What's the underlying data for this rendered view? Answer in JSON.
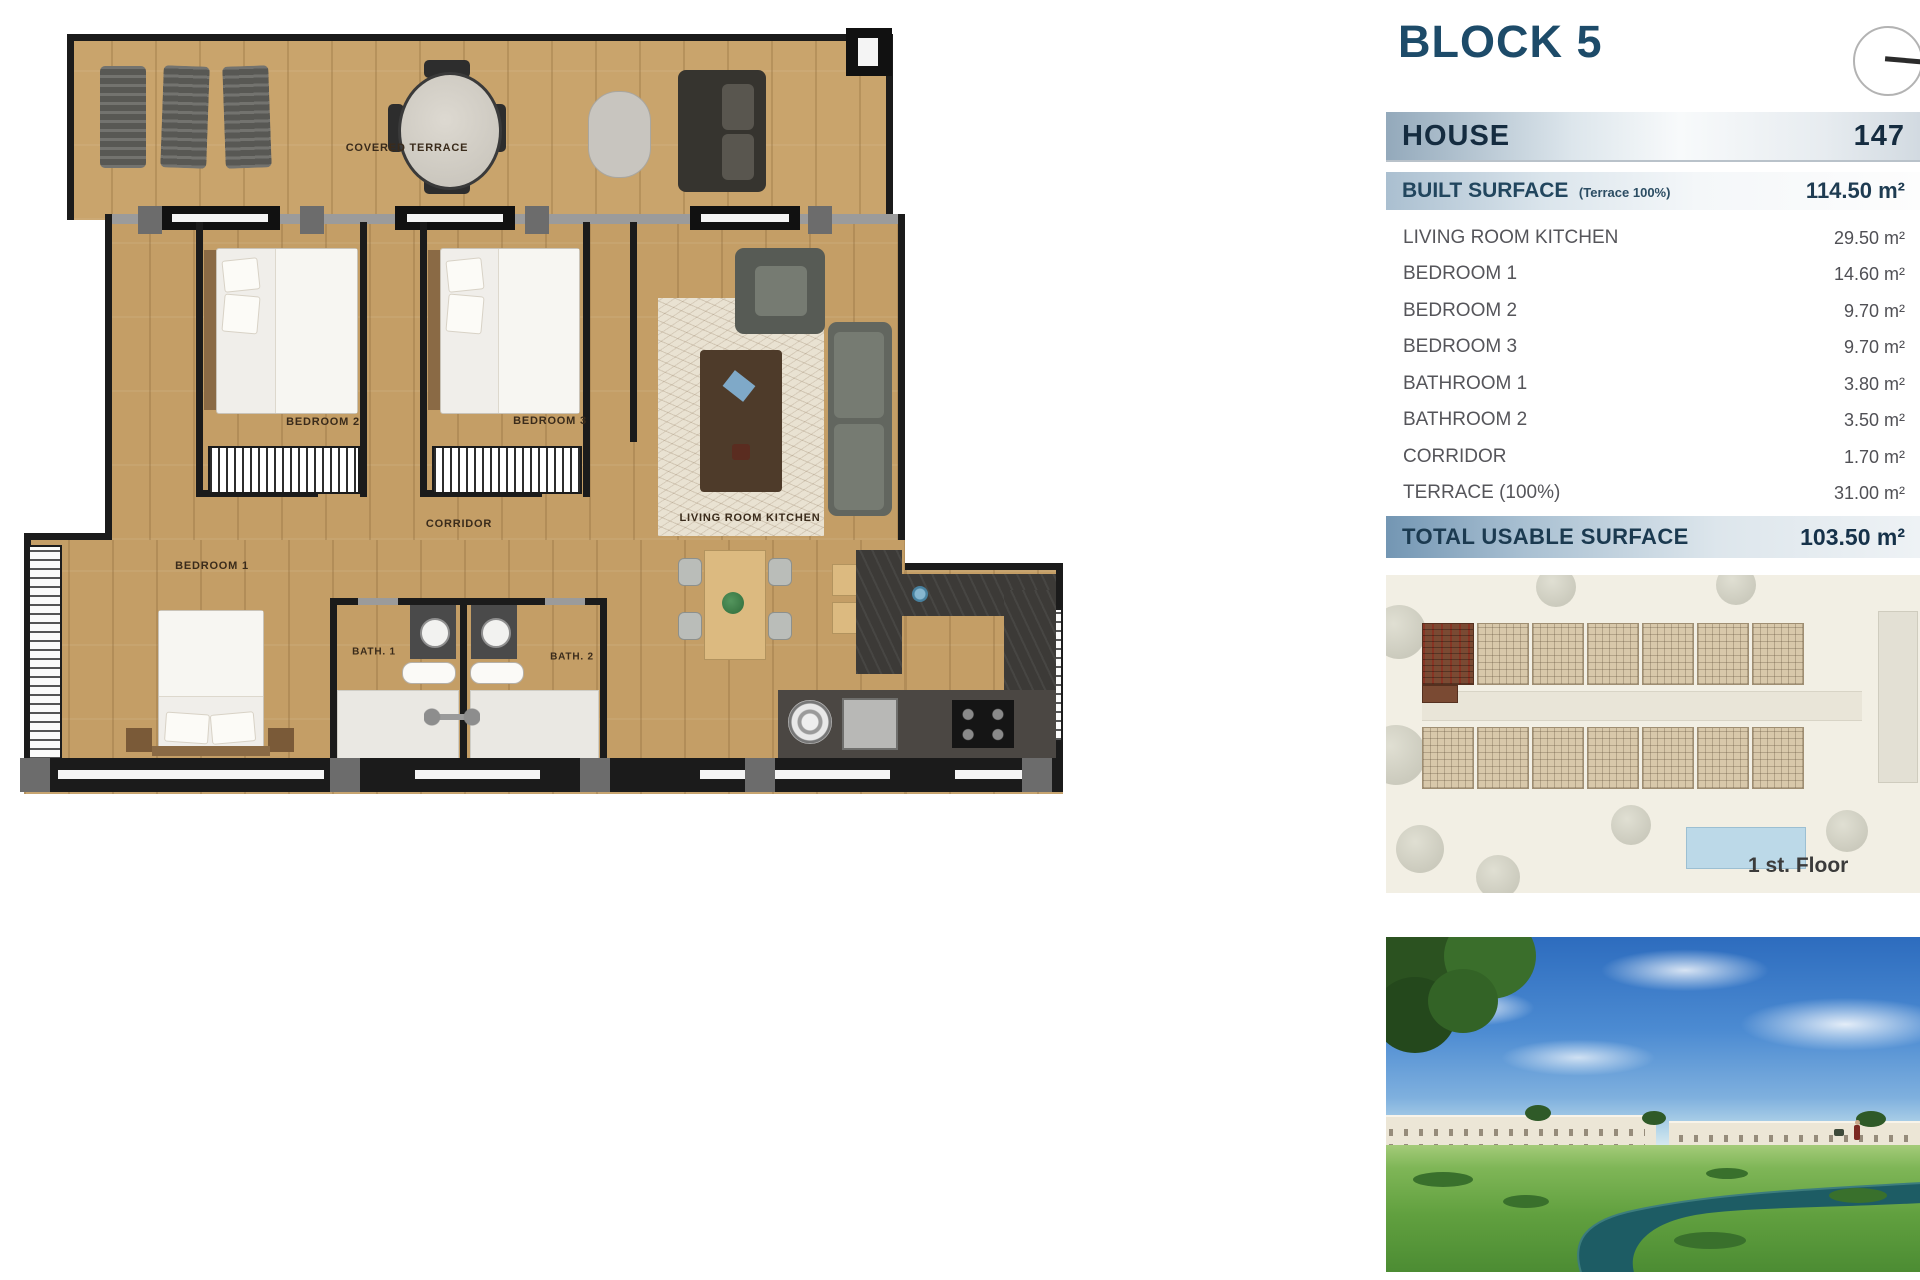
{
  "panel": {
    "title": "BLOCK 5",
    "house_label": "HOUSE",
    "house_value": "147",
    "built_label": "BUILT SURFACE",
    "built_note": "(Terrace 100%)",
    "built_value": "114.50 m²",
    "rooms": [
      {
        "label": "LIVING ROOM KITCHEN",
        "value": "29.50 m²"
      },
      {
        "label": "BEDROOM 1",
        "value": "14.60 m²"
      },
      {
        "label": "BEDROOM 2",
        "value": "9.70 m²"
      },
      {
        "label": "BEDROOM 3",
        "value": "9.70 m²"
      },
      {
        "label": "BATHROOM 1",
        "value": "3.80 m²"
      },
      {
        "label": "BATHROOM 2",
        "value": "3.50 m²"
      },
      {
        "label": "CORRIDOR",
        "value": "1.70 m²"
      },
      {
        "label": "TERRACE (100%)",
        "value": "31.00 m²"
      }
    ],
    "total_label": "TOTAL USABLE SURFACE",
    "total_value": "103.50 m²",
    "floor_caption": "1 st. Floor"
  },
  "plan": {
    "covered_terrace": "COVERED TERRACE",
    "bedroom2": "BEDROOM 2",
    "bedroom3": "BEDROOM 3",
    "corridor": "CORRIDOR",
    "living": "LIVING ROOM KITCHEN",
    "bedroom1": "BEDROOM 1",
    "bath1": "BATH. 1",
    "bath2": "BATH. 2"
  },
  "colors": {
    "accent_navy": "#1d4b69",
    "bar_blue": "#7396b3",
    "wood": "#c49e66",
    "highlight_unit": "#7a4a33",
    "river": "#1d5c64"
  }
}
